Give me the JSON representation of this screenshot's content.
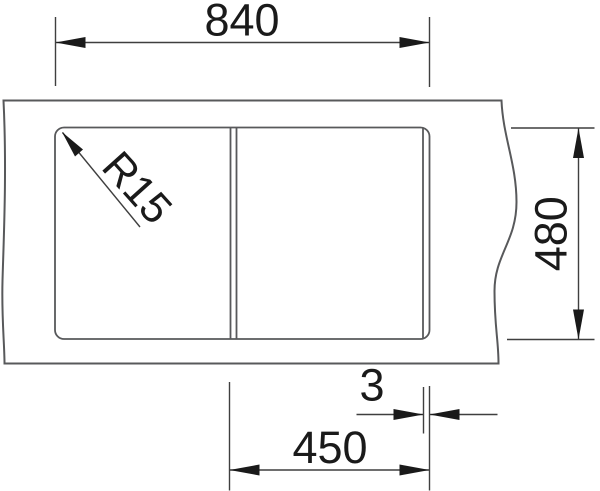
{
  "diagram": {
    "type": "technical-dimension-drawing",
    "subject": "kitchen sink top view with bowl and divider",
    "labels": {
      "overall_width": "840",
      "depth": "480",
      "bowl_width": "450",
      "divider_width": "3",
      "corner_radius": "R15"
    },
    "colors": {
      "background": "#ffffff",
      "drawing_line": "#58595b",
      "dimension_line": "#3f3f3f",
      "text_and_arrows": "#1a1a1a"
    }
  }
}
